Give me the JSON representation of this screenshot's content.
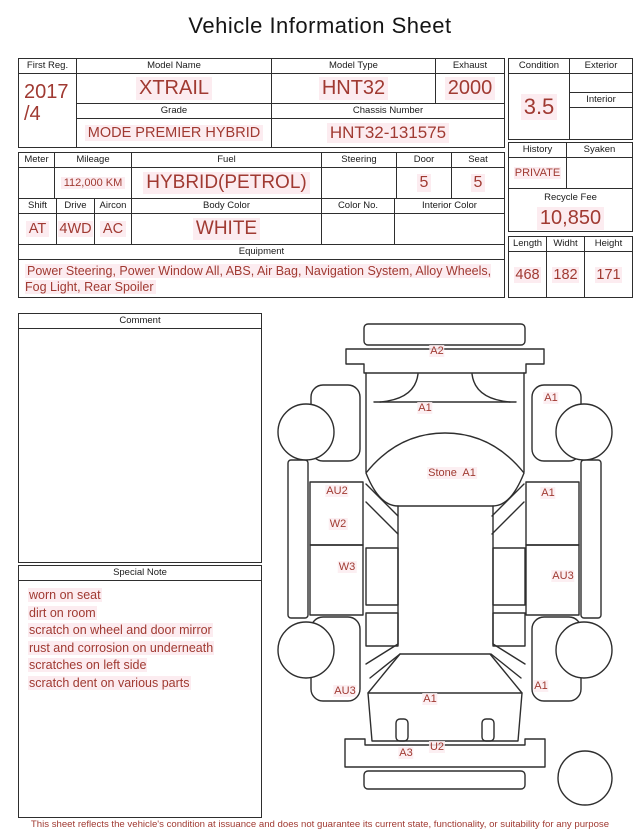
{
  "title": "Vehicle Information Sheet",
  "vehicle": {
    "first_reg_label": "First Reg.",
    "first_reg_line1": "2017",
    "first_reg_line2": "/4",
    "model_name_label": "Model Name",
    "model_name": "XTRAIL",
    "model_type_label": "Model Type",
    "model_type": "HNT32",
    "exhaust_label": "Exhaust",
    "exhaust": "2000",
    "grade_label": "Grade",
    "grade": "MODE PREMIER HYBRID",
    "chassis_number_label": "Chassis Number",
    "chassis_number": "HNT32-131575"
  },
  "condition": {
    "condition_label": "Condition",
    "condition_score": "3.5",
    "exterior_label": "Exterior",
    "exterior": "",
    "interior_label": "Interior",
    "interior": ""
  },
  "details": {
    "meter_label": "Meter",
    "meter": "",
    "mileage_label": "Mileage",
    "mileage": "112,000 KM",
    "fuel_label": "Fuel",
    "fuel": "HYBRID(PETROL)",
    "steering_label": "Steering",
    "steering": "",
    "door_label": "Door",
    "door": "5",
    "seat_label": "Seat",
    "seat": "5",
    "shift_label": "Shift",
    "shift": "AT",
    "drive_label": "Drive",
    "drive": "4WD",
    "aircon_label": "Aircon",
    "aircon": "AC",
    "body_color_label": "Body Color",
    "body_color": "WHITE",
    "color_no_label": "Color No.",
    "color_no": "",
    "interior_color_label": "Interior Color",
    "interior_color": ""
  },
  "history": {
    "history_label": "History",
    "history": "PRIVATE",
    "syaken_label": "Syaken",
    "syaken": "",
    "recycle_fee_label": "Recycle Fee",
    "recycle_fee": "10,850"
  },
  "dimensions": {
    "length_label": "Length",
    "length": "468",
    "width_label": "Widht",
    "width": "182",
    "height_label": "Height",
    "height": "171"
  },
  "equipment": {
    "label": "Equipment",
    "text": "Power Steering, Power Window  All, ABS, Air Bag, Navigation System, Alloy Wheels, Fog Light, Rear Spoiler"
  },
  "comment": {
    "label": "Comment",
    "text": ""
  },
  "special_note": {
    "label": "Special Note",
    "lines": [
      "worn on seat",
      "dirt on room",
      "scratch on wheel and door mirror",
      "rust and corrosion on underneath",
      "scratches on left side",
      "scratch dent on various parts"
    ]
  },
  "diagram": {
    "labels": [
      {
        "part": "front-bumper",
        "text": "A2"
      },
      {
        "part": "hood",
        "text": "A1"
      },
      {
        "part": "front-right-fender",
        "text": "A1"
      },
      {
        "part": "windshield",
        "text": "Stone  A1"
      },
      {
        "part": "front-left-door-upper",
        "text": "AU2"
      },
      {
        "part": "front-right-door",
        "text": "A1"
      },
      {
        "part": "front-left-door-lower",
        "text": "W2"
      },
      {
        "part": "rear-left-door",
        "text": "W3"
      },
      {
        "part": "rear-right-door",
        "text": "AU3"
      },
      {
        "part": "rear-left-fender",
        "text": "AU3"
      },
      {
        "part": "tailgate",
        "text": "A1"
      },
      {
        "part": "rear-right-fender",
        "text": "A1"
      },
      {
        "part": "rear-bumper-left",
        "text": "A3"
      },
      {
        "part": "rear-bumper-center",
        "text": "U2"
      }
    ]
  },
  "footer": "This sheet reflects the vehicle's condition at issuance and does not guarantee its current state, functionality, or suitability for any purpose",
  "colors": {
    "accent": "#a03a32",
    "highlight": "#fcecf0"
  }
}
